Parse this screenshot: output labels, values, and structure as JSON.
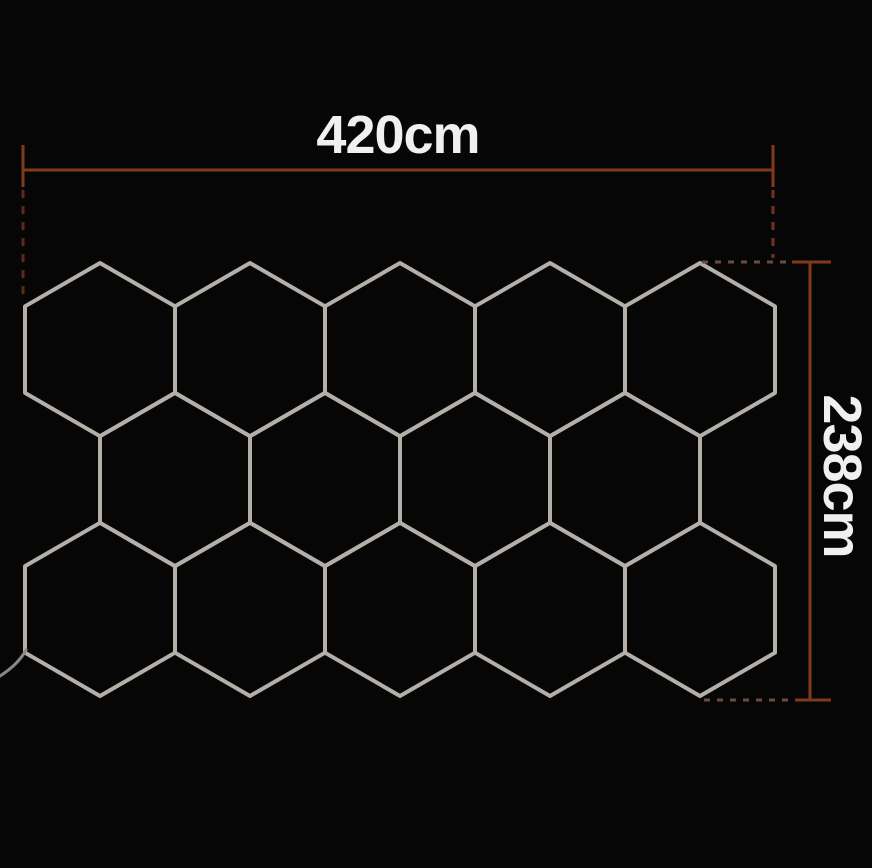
{
  "canvas": {
    "background": "#060606"
  },
  "hex_grid": {
    "stroke_color": "#b5afa9",
    "stroke_width": 4,
    "side": 86.6,
    "half_width": 75,
    "rows": [
      {
        "center_y": 349.6,
        "centers_x": [
          100,
          250,
          400,
          550,
          700
        ]
      },
      {
        "center_y": 479.5,
        "centers_x": [
          175,
          325,
          475,
          625
        ]
      },
      {
        "center_y": 609.4,
        "centers_x": [
          100,
          250,
          400,
          550,
          700
        ]
      }
    ]
  },
  "cable": {
    "color": "#8d8781",
    "stroke_width": 3,
    "path": "M 26 650 C 20 661 11 669 0 676"
  },
  "dimensions": {
    "color": "#82391b",
    "stroke_width": 3,
    "dash_width": 3,
    "text_color": "#f2f0ee",
    "width_dim": {
      "label": "420cm",
      "line": {
        "x1": 23,
        "x2": 773,
        "y": 170
      },
      "ticks": [
        {
          "x": 23,
          "y1": 145,
          "y2": 187
        },
        {
          "x": 773,
          "y1": 145,
          "y2": 187
        }
      ],
      "dashed_extensions": [
        {
          "x1": 23,
          "y1": 190,
          "x2": 23,
          "y2": 300,
          "color": "#63281a",
          "dash": "8 8"
        },
        {
          "x1": 773,
          "y1": 190,
          "x2": 773,
          "y2": 258,
          "color": "#6d3521",
          "dash": "8 8"
        }
      ]
    },
    "height_dim": {
      "label": "238cm",
      "line": {
        "x": 810,
        "y1": 262,
        "y2": 700
      },
      "ticks": [
        {
          "y": 262,
          "x1": 792,
          "x2": 831
        },
        {
          "y": 700,
          "x1": 795,
          "x2": 831
        }
      ],
      "dashed_extensions": [
        {
          "x1": 702,
          "y1": 262,
          "x2": 787,
          "y2": 262,
          "color": "#6a4b3d",
          "dash": "6 7"
        },
        {
          "x1": 704,
          "y1": 700,
          "x2": 791,
          "y2": 700,
          "color": "#6a4b3d",
          "dash": "6 7"
        }
      ]
    }
  }
}
